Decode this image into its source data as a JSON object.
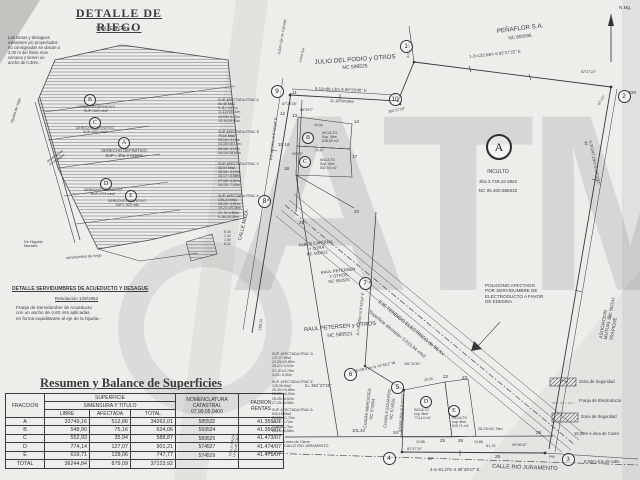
{
  "watermark": "ATM",
  "north": {
    "label": "N.Mg."
  },
  "detail": {
    "title": "DETALLE DE RIEGO",
    "subtitle": "SIN ESCALA",
    "note": "Las tomas y desagues\nexistentes y/o proyectados\nno consignados se ubican a\n3,00 m del límite mas\ncercano y tienen un\nancho de 0,30m.-",
    "labels": {
      "a": "DERECHO DEFINITIVO\nSUP.= 3ha 3.749m2",
      "b": "DERECHO DEFINITIVO\nSUP.=549 mts2",
      "c": "DERECHO DEFINITIVO\nSUP.=553 mts2",
      "d": "DERECHO DEFINITIVO\nSUP.=774 mts2",
      "e": "DERECHO DEFINITIVO\nSUP.= 620 mts"
    },
    "side": {
      "hijuela": "hijuela de riego",
      "higuelo": "De Higuelo\nMorales",
      "desague": "servidumbre\nde desague",
      "riego": "servidumbre de riego",
      "dims": "5,45\n1,30\n1,50\n5,00"
    }
  },
  "servidumbre": {
    "title": "DETALLE SERVIDUMBRES DE ACUEDUCTO Y DESAGUE",
    "resolution": "Resolucion 129/1952",
    "note": "Franja de Servidumbre de Acueducto\ncon un ancho de 4,60 mts aplicadas\nen forma equidistante al eje de la hijuela.-"
  },
  "table": {
    "title": "Resumen y Balance de Superficies",
    "col_fraccion": "FRACCION",
    "h_superficie": "SUPERFICIE",
    "h_mensura": "S/MENSURA Y TITULO",
    "h_libre": "LIBRE",
    "h_afectada": "AFECTADA",
    "h_total": "TOTAL",
    "h_nomenclatura": "NOMENCLATURA\nCATASTRAL\n07.99.05.0400",
    "h_padron": "PADRON\nRENTAS",
    "rows": [
      [
        "A",
        "33749,16",
        "512,86",
        "34262,01",
        "585532",
        "41.355/07"
      ],
      [
        "B",
        "548,90",
        "75,16",
        "624,06",
        "593524",
        "41.356/07"
      ],
      [
        "C",
        "552,93",
        "35,94",
        "588,87",
        "589525",
        "41.473/07"
      ],
      [
        "D",
        "774,14",
        "127,07",
        "901,21",
        "574527",
        "41.474/07"
      ],
      [
        "E",
        "619,71",
        "128,06",
        "747,77",
        "574529",
        "41.479/07"
      ],
      [
        "TOTAL",
        "36244,84",
        "879,09",
        "37123,92",
        "",
        ""
      ]
    ]
  },
  "map": {
    "big": [
      "1",
      "2",
      "3",
      "4",
      "5",
      "6",
      "7",
      "8",
      "9",
      "10"
    ],
    "letters": [
      "A",
      "B",
      "C",
      "D",
      "E"
    ],
    "pts": [
      "11",
      "12",
      "13",
      "14",
      "15 16",
      "17",
      "18",
      "20",
      "21",
      "22",
      "23",
      "24",
      "25",
      "26",
      "27",
      "28",
      "29"
    ],
    "owners": {
      "julio": "JULIO DEL PODIO y OTROS",
      "julio_nc": "NC 596525",
      "penaflor": "PEÑAFLOR S.A.",
      "penaflor_nc": "NC 605596",
      "pablo": "PABLO CARQUEL\nY OTRA\nNC 580522",
      "raul1": "RAUL PETERSEN\nY OTROS\nNC 593526",
      "raul2": "RAUL PETERSEN y OTROS",
      "raul2_nc": "NC 580521",
      "asociacion": "ASOCIACION MUTUAL EL TRAPICHE",
      "asociacion_nc": "NC 582543",
      "chiara": "CHIARA MERCEDES\nNC 575504",
      "charls": "CHARLS EDUARDO\nNC 574525"
    },
    "parcels": {
      "a": "INCULTO",
      "a2": "3ha 3.749,16 Mts2",
      "a3": "NC 05.400.585532",
      "b": "INCULTO\nSup. libre\n548,90 m2",
      "c": "INCULTO\nSup. libre\n552,93 m2",
      "d": "INCULTO\nsup. libre\n774,14 m2",
      "e": "INCULTO\nsup. libre\n619,71 m2"
    },
    "electro": {
      "eje": "EJE TENDIDO ELECTRICO de 66 Kv",
      "sup": "Superficie afectada= 5.013,44 mts2",
      "poligono": "POLIGONO AFECTADO\nPOR SERVIDUMBRE DE\nELECTRODUCTO A FAVOR\nDE EDEMSA"
    },
    "legend": {
      "zona1": "Zona de Seguridad",
      "franja": "Franja de Electroducto",
      "zona2": "Zona de Seguridad",
      "cierre": "15,00m–Línea de Cierre",
      "eje_calle": "0,50m–Eje de calle"
    },
    "roads": {
      "maza": "CALLE MAZA",
      "rio": "CALLE RIO JURAMENTO",
      "cierre_left": "Línea de Cierre\nCALLE RIO JURAMENTO",
      "maza2": "CALLE MAZA\nLínea de Cierre",
      "eje_calzada": "0,50m–Eje de Calzada",
      "linea_sur": "Línea Sur"
    },
    "bearings": {
      "b12": "1-2=132,53m S 82°27'22\" E",
      "b23": "2-3=247,19m S 10°16'2\" W",
      "b910": "9-10=88,13m S 89°29'46\" E",
      "b1110": "11-10=84,88m",
      "b89": "8-9=64,06m N 8°43'19\" E",
      "b87": "8-7=59,86m N 8°43'19\" E",
      "b45": "4-5=66,36m N 8°43'19\" E",
      "b56": "5-6=39,57m N 74°45'2\" W",
      "b34": "3-4=91,27m S 89°28'47\" E",
      "b2829": "28-29=51,78m",
      "b31": "3-1=5,48m",
      "d101": "101,34",
      "d5176": "51,76",
      "d2888": "28,88",
      "d2387": "23,87",
      "d2065": "20,65",
      "d1988a": "19,88",
      "d1988b": "19,88",
      "d10016": "100,16",
      "a9": "87°29'28\"",
      "a10": "262°27'28\"",
      "a13": "88°29'2\"",
      "a15": "90°0'0\"",
      "a2a": "82°27'22\"",
      "a2b": "87°4'2\"",
      "a4": "81°47'24\"",
      "a3": "99°46'42\"",
      "a5": "161°11'50\"",
      "sigma": "Σ= 262°27'21\"",
      "em": "EM",
      "pm": "PM"
    },
    "fracs": {
      "fa1": "SUP. AFECTADA-FRAC A\n66,45 Mts2\n9-11= 4,15m\n11-12=15,00m\n12-13= 4,15m\n13- 9=15,00m",
      "fb": "SUP. AFECTADA-FRAC B\n75,16 Mts2\n13-14= 4,15m\n14-15=18,15m\n15-16= 4,15m\n16-13=18,00m",
      "fc": "SUP. AFECTADA-FRAC C\n35,94 Mts2\n15-16= 4,15m\n16-17= 8,88m\n17-18= 4,82m\n18-15= 7,43m",
      "fa2": "SUP. AFECTADA-FRAC A\n106,24 Mts2\n18-19= 4,82m\n19-21=25,38m\n21- 9= 4,80m\n9-18=25,38m",
      "fd": "SUP. AFECTADA-FRAC D\n127,07 Mts2\n24-25=19,88m\n25-27= 6,52m\n27- 4=12,78m\n4-24= 6,00m",
      "fe": "SUP. AFECTADA-FRAC E\n128,06 Mts2\n25-26=19,88m\n26-28=16,93m\n28-25= 6,52m\n27-25= 6,58m",
      "fa3": "SUP. AFECTADA-FRAC A\n540,15 Mts2\n29-30=51,79m\n30- 3= 6,74m\n3-28=51,75m\n28-29= 6,58m"
    }
  }
}
